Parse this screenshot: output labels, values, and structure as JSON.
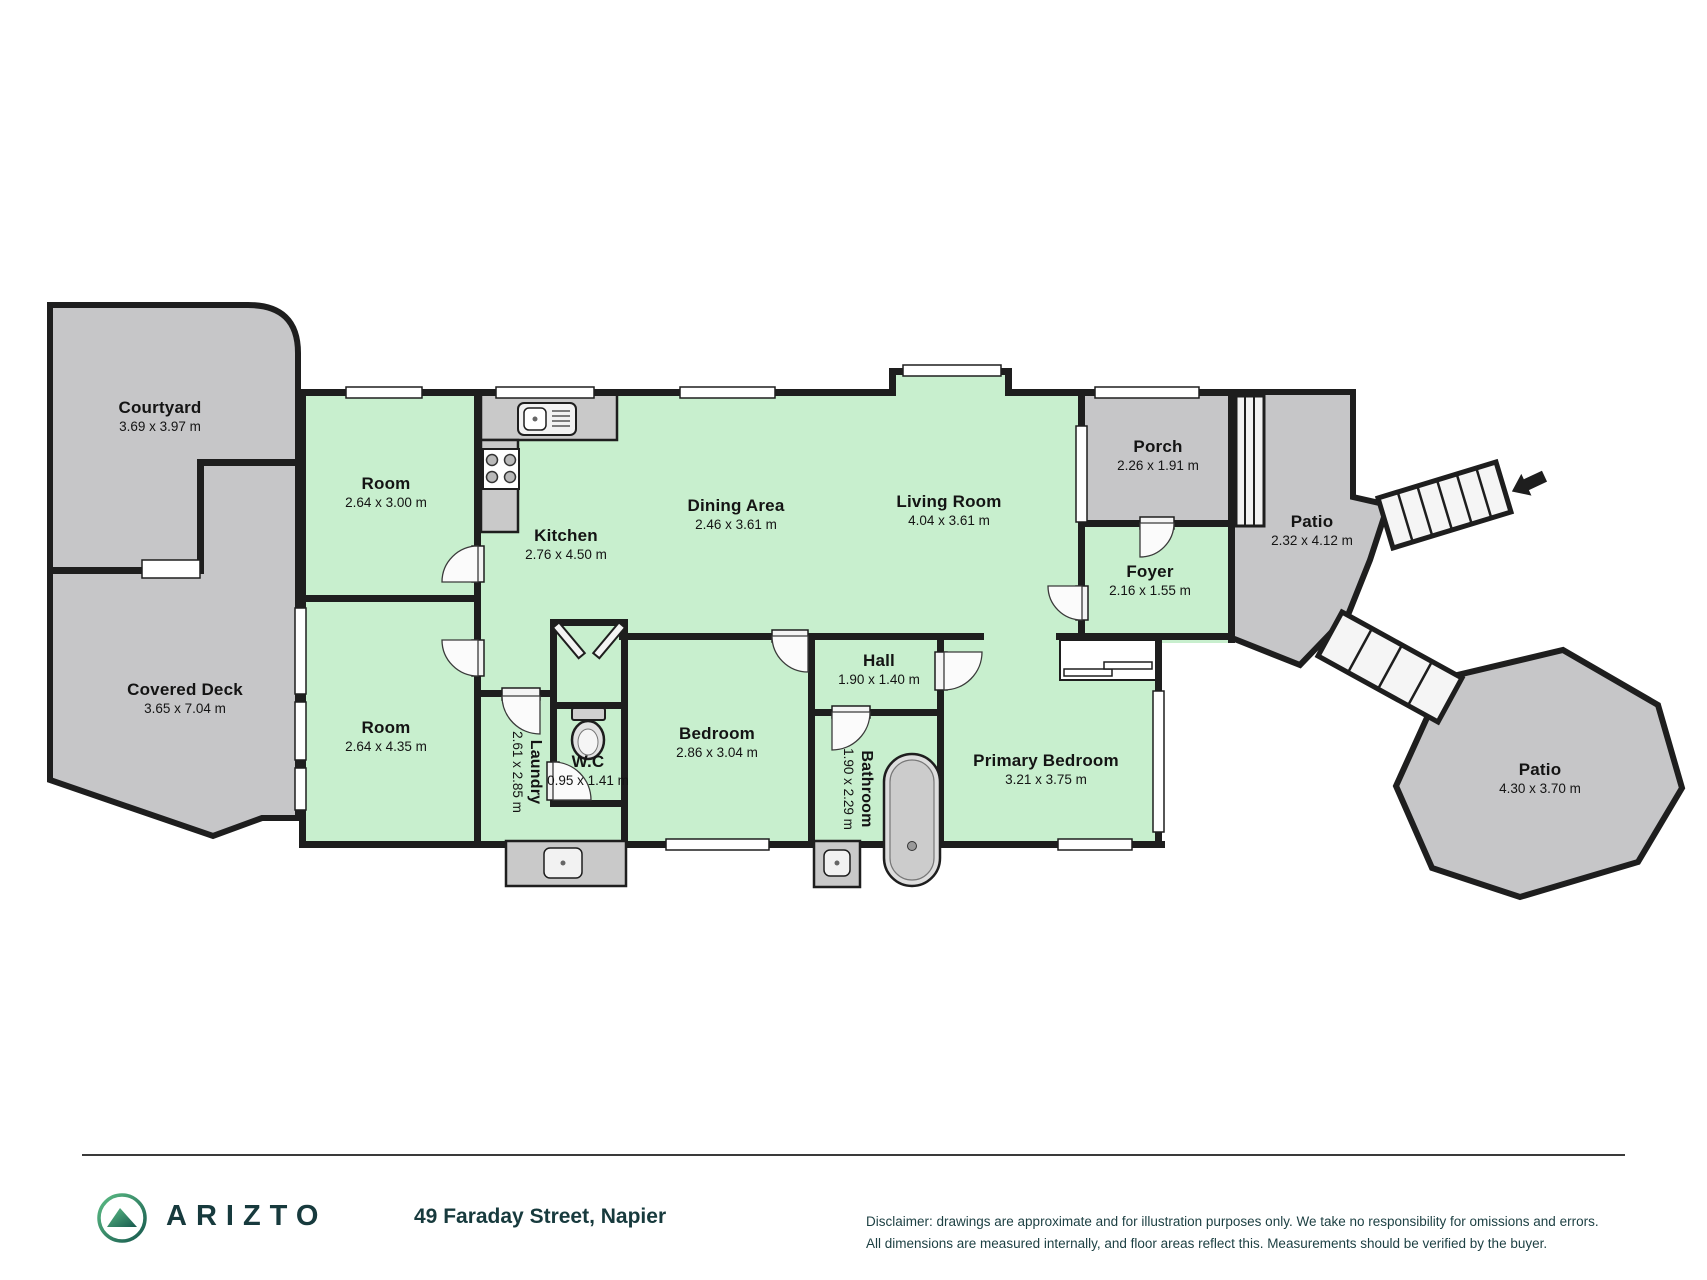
{
  "plan": {
    "rooms": {
      "courtyard": {
        "name": "Courtyard",
        "dims": "3.69 x 3.97 m"
      },
      "covered_deck": {
        "name": "Covered Deck",
        "dims": "3.65 x 7.04 m"
      },
      "room_top": {
        "name": "Room",
        "dims": "2.64 x 3.00 m"
      },
      "kitchen": {
        "name": "Kitchen",
        "dims": "2.76 x 4.50 m"
      },
      "dining_area": {
        "name": "Dining Area",
        "dims": "2.46 x 3.61 m"
      },
      "living_room": {
        "name": "Living Room",
        "dims": "4.04 x 3.61 m"
      },
      "porch": {
        "name": "Porch",
        "dims": "2.26 x 1.91 m"
      },
      "patio_upper": {
        "name": "Patio",
        "dims": "2.32 x 4.12 m"
      },
      "foyer": {
        "name": "Foyer",
        "dims": "2.16 x 1.55 m"
      },
      "room_bottom": {
        "name": "Room",
        "dims": "2.64 x 4.35 m"
      },
      "laundry": {
        "name": "Laundry",
        "dims": "2.61 x 2.85 m"
      },
      "wc": {
        "name": "W.C",
        "dims": "0.95 x 1.41 m"
      },
      "bedroom": {
        "name": "Bedroom",
        "dims": "2.86 x 3.04 m"
      },
      "hall": {
        "name": "Hall",
        "dims": "1.90 x 1.40 m"
      },
      "bathroom": {
        "name": "Bathroom",
        "dims": "1.90 x 2.29 m"
      },
      "primary_bedroom": {
        "name": "Primary Bedroom",
        "dims": "3.21 x 3.75 m"
      },
      "patio_lower": {
        "name": "Patio",
        "dims": "4.30 x 3.70 m"
      }
    },
    "colors": {
      "room_fill": "#c8efce",
      "outdoor_fill": "#c6c6c8",
      "wall": "#1e1e1e"
    }
  },
  "footer": {
    "brand": "ARIZTO",
    "address": "49 Faraday Street, Napier",
    "disclaimer_line1": "Disclaimer: drawings are approximate and for illustration purposes only. We take no responsibility for omissions and errors.",
    "disclaimer_line2": "All dimensions are measured internally, and floor areas reflect this. Measurements should be verified by the buyer."
  }
}
